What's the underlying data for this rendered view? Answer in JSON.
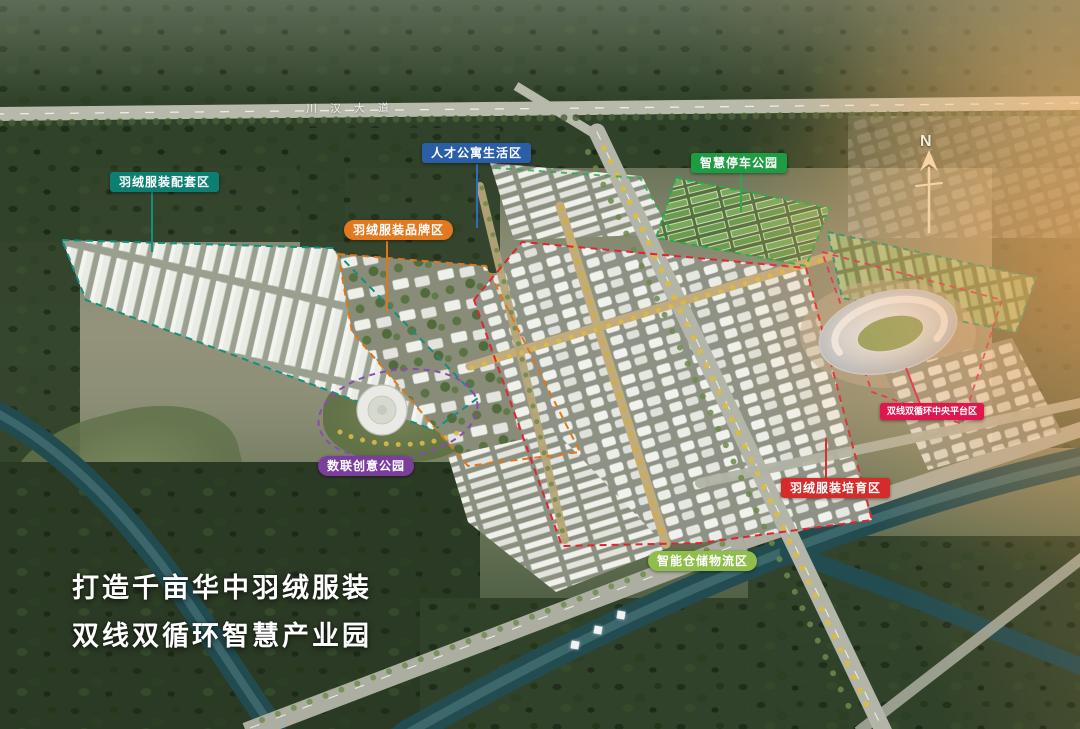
{
  "hero": {
    "slogan_line1": "打造千亩华中羽绒服装",
    "slogan_line2": "双线双循环智慧产业园"
  },
  "compass": {
    "label": "N"
  },
  "roads": {
    "top_road_name": "川汉大道"
  },
  "river_name_glyphs_note": "3 illegible white characters painted on the river",
  "zone_labels": [
    {
      "text": "羽绒服装配套区",
      "color": "#0d7f72",
      "shape": "rect"
    },
    {
      "text": "人才公寓生活区",
      "color": "#2a5fa8",
      "shape": "rect"
    },
    {
      "text": "智慧停车公园",
      "color": "#1d9c44",
      "shape": "rect"
    },
    {
      "text": "羽绒服装品牌区",
      "color": "#e2791e",
      "shape": "pill"
    },
    {
      "text": "数联创意公园",
      "color": "#7a3f9d",
      "shape": "pill"
    },
    {
      "text": "双线双循环中央平台区",
      "color": "#e0164f",
      "shape": "rect"
    },
    {
      "text": "羽绒服装培育区",
      "color": "#d62b2b",
      "shape": "rect"
    },
    {
      "text": "智能仓储物流区",
      "color": "#8fbe4b",
      "shape": "pill"
    }
  ]
}
